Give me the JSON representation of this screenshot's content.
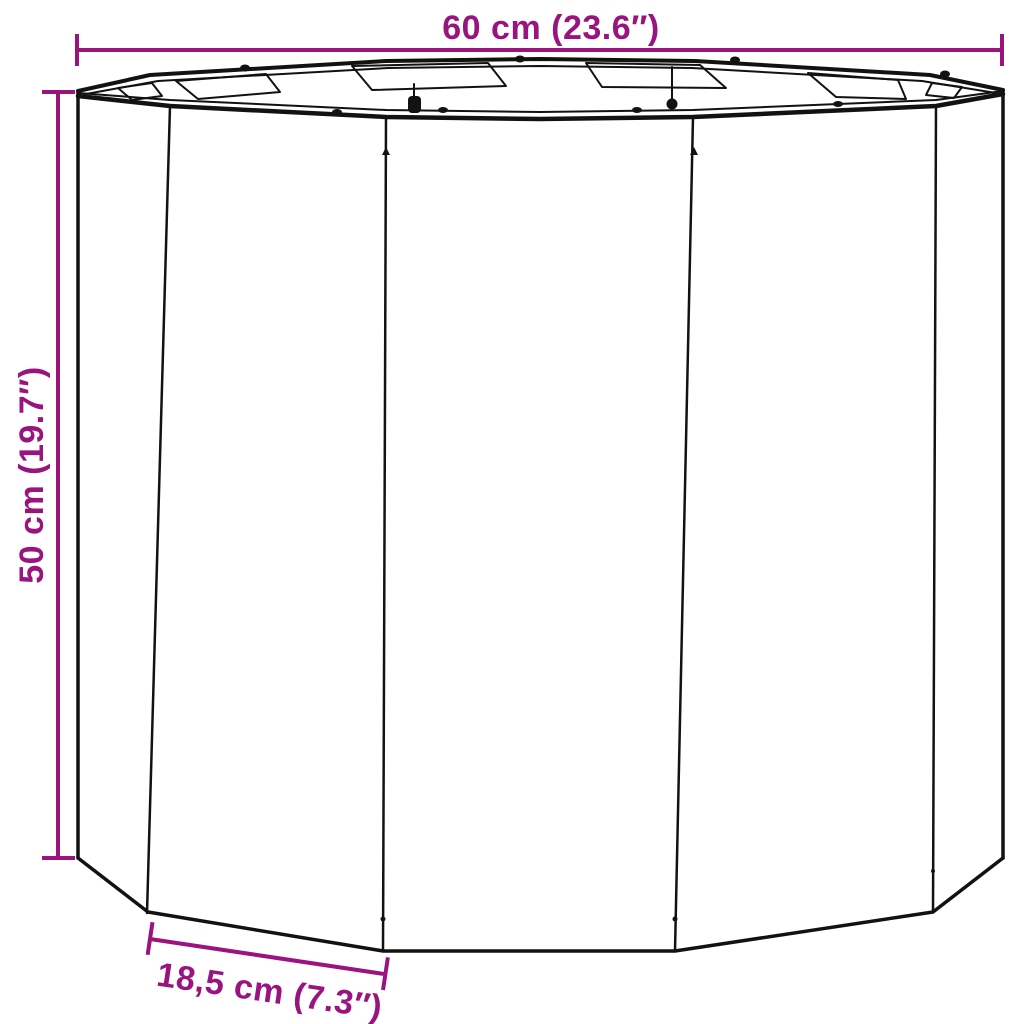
{
  "canvas": {
    "background": "#ffffff"
  },
  "colors": {
    "dimension": "#9A1480",
    "line_art": "#121212",
    "background": "#ffffff"
  },
  "dimensions": {
    "width": {
      "label": "60 cm (23.6″)"
    },
    "height": {
      "label": "50 cm (19.7″)"
    },
    "panel": {
      "label": "18,5 cm (7.3″)"
    }
  }
}
